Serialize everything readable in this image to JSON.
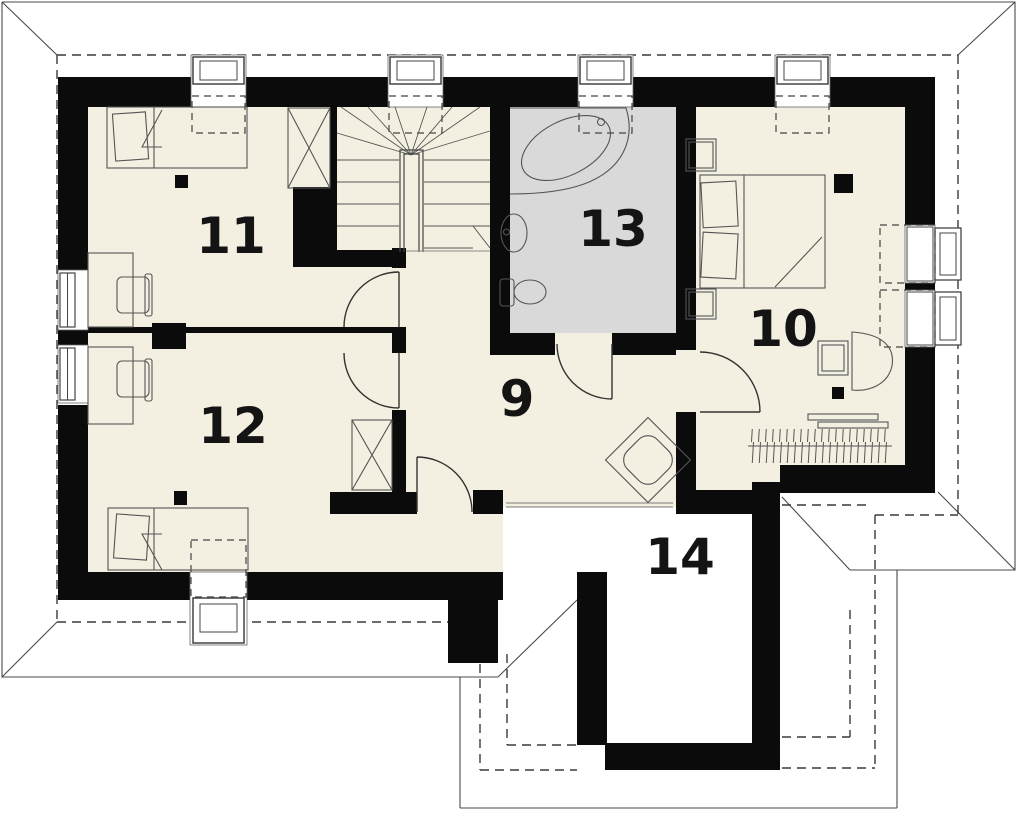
{
  "drawing": {
    "kind": "attic floor plan",
    "room_count_shown": 6
  },
  "rooms": [
    {
      "id": "room-9",
      "label": "9"
    },
    {
      "id": "room-10",
      "label": "10"
    },
    {
      "id": "room-11",
      "label": "11"
    },
    {
      "id": "room-12",
      "label": "12"
    },
    {
      "id": "room-13",
      "label": "13"
    },
    {
      "id": "room-14",
      "label": "14"
    }
  ],
  "colors": {
    "wall": "#0b0b0b",
    "floor": "#f4f0e1",
    "bathroom_floor": "#d9d9d9",
    "line": "#4a4a4a",
    "dashed_line": "#3a3a3a",
    "label": "#141414",
    "background": "#ffffff"
  },
  "fixture_icons": [
    "staircase-icon",
    "corner-bathtub-icon",
    "washbasin-icon",
    "toilet-icon",
    "double-bed-icon",
    "single-bed-icon",
    "wardrobe-icon",
    "desk-icon",
    "desk-chair-icon",
    "stool-icon",
    "armchair-icon",
    "radiator-icon",
    "chimney-column-icon",
    "dormer-window-icon",
    "window-icon",
    "door-icon",
    "roof-outline-icon"
  ]
}
